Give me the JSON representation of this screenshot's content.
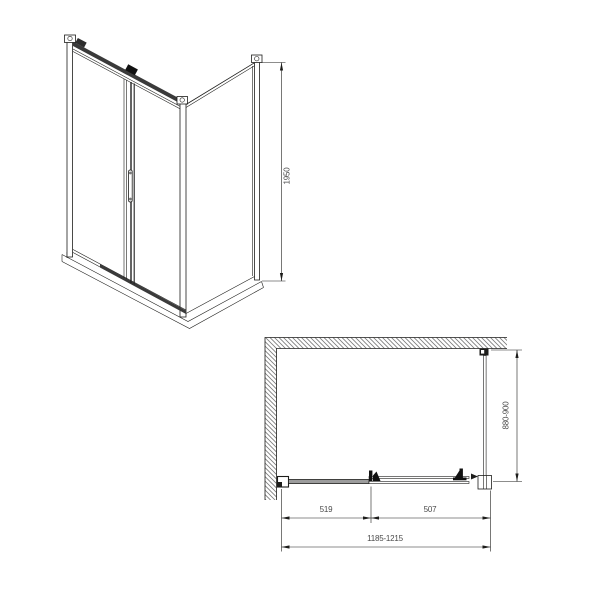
{
  "drawing": {
    "kind": "shower-enclosure-technical-drawing",
    "background": "#ffffff"
  },
  "colors": {
    "line": "#1d1d1b",
    "rail_dark": "#3a3a3a",
    "track_gray": "#9c9c9c",
    "hatch": "#777777",
    "dim_text": "#4a4a4a"
  },
  "dimensions": {
    "front_height": "1950",
    "plan_depth": "880-900",
    "plan_segment_left": "519",
    "plan_segment_right": "507",
    "plan_total_width": "1185-1215"
  }
}
